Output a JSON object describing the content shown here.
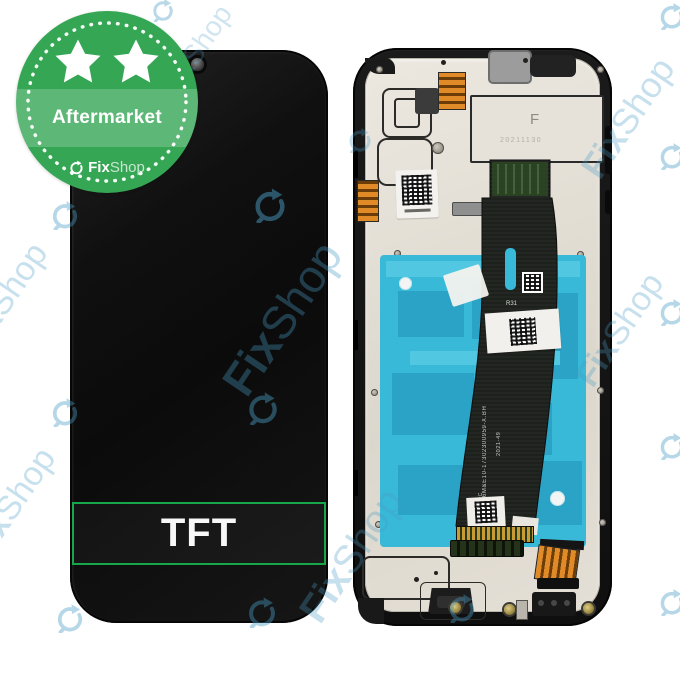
{
  "colors": {
    "badge-green": "#35a654",
    "badge-band": "rgba(255,255,255,0.20)",
    "tft-green": "#17a74b",
    "cyan": "#38b9d8",
    "cyan-dark": "#2aa3c6",
    "watermark-blue": "#4a9cc4",
    "orange": "#e08a28"
  },
  "badge": {
    "label": "Aftermarket",
    "brand_bold": "Fix",
    "brand_light": "Shop",
    "star_count": 2
  },
  "front_panel": {
    "type_label": "TFT"
  },
  "back_panel": {
    "plate_marking": "F",
    "plate_date_code": "20211130",
    "flex_marking": "R31",
    "flex_fpc_marking": "FPC",
    "flex_serial": "D6M&E10-17302300959-X.BH",
    "flex_date_code": "2021-49"
  },
  "watermark": {
    "brand_bold": "Fix",
    "brand_light": "Shop",
    "icons": [
      {
        "x": 163,
        "y": 10,
        "s": 24,
        "o": 0.38
      },
      {
        "x": 65,
        "y": 215,
        "s": 30,
        "o": 0.4
      },
      {
        "x": 65,
        "y": 412,
        "s": 30,
        "o": 0.4
      },
      {
        "x": 70,
        "y": 618,
        "s": 30,
        "o": 0.4
      },
      {
        "x": 270,
        "y": 205,
        "s": 36,
        "o": 0.5
      },
      {
        "x": 263,
        "y": 408,
        "s": 34,
        "o": 0.45
      },
      {
        "x": 262,
        "y": 612,
        "s": 32,
        "o": 0.42
      },
      {
        "x": 462,
        "y": 608,
        "s": 30,
        "o": 0.4
      },
      {
        "x": 360,
        "y": 140,
        "s": 26,
        "o": 0.3
      },
      {
        "x": 672,
        "y": 16,
        "s": 28,
        "o": 0.4
      },
      {
        "x": 672,
        "y": 156,
        "s": 28,
        "o": 0.4
      },
      {
        "x": 672,
        "y": 312,
        "s": 28,
        "o": 0.4
      },
      {
        "x": 672,
        "y": 446,
        "s": 28,
        "o": 0.4
      },
      {
        "x": 672,
        "y": 602,
        "s": 28,
        "o": 0.4
      }
    ],
    "texts": [
      {
        "x": 282,
        "y": 318,
        "f": 46,
        "o": 0.35
      },
      {
        "x": 352,
        "y": 556,
        "f": 40,
        "o": 0.3
      },
      {
        "x": 628,
        "y": 118,
        "f": 36,
        "o": 0.3
      },
      {
        "x": 620,
        "y": 330,
        "f": 34,
        "o": 0.3
      },
      {
        "x": 4,
        "y": 300,
        "f": 34,
        "o": 0.3
      },
      {
        "x": 12,
        "y": 505,
        "f": 34,
        "o": 0.3
      },
      {
        "x": 196,
        "y": 52,
        "f": 28,
        "o": 0.25
      }
    ]
  }
}
